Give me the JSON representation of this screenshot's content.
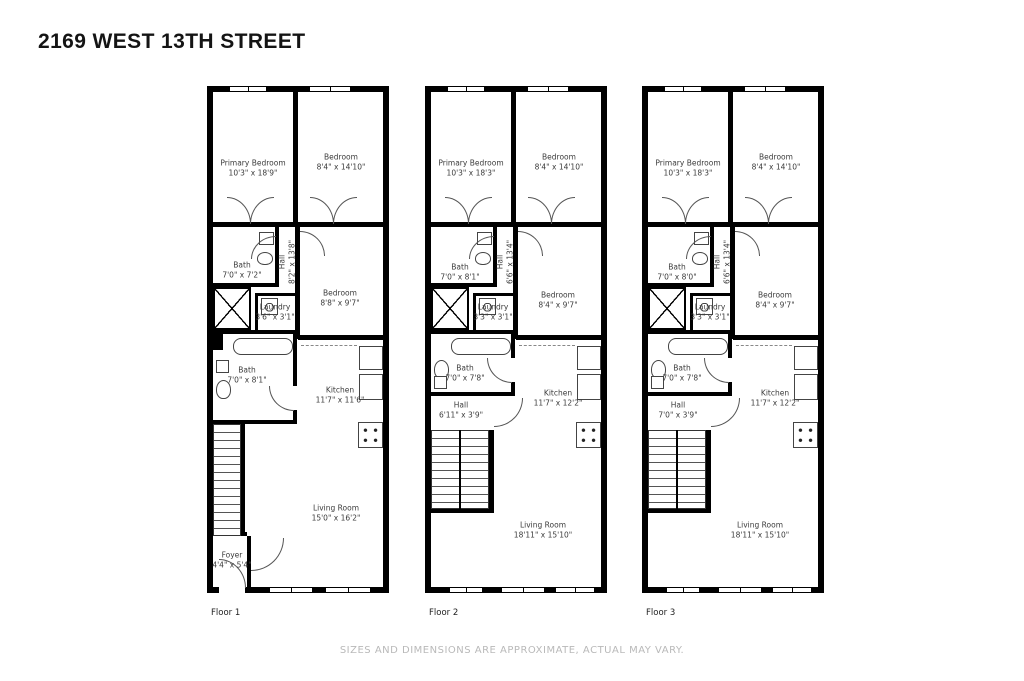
{
  "page": {
    "title": "2169 WEST 13TH STREET",
    "disclaimer": "SIZES AND DIMENSIONS ARE APPROXIMATE, ACTUAL MAY VARY."
  },
  "colors": {
    "wall": "#000000",
    "room_label": "#3b3b3b",
    "disclaimer_text": "#b9b9b9"
  },
  "floors": [
    {
      "label": "Floor 1",
      "rooms": {
        "primary_bedroom": {
          "name": "Primary Bedroom",
          "dims": "10'3\" x 18'9\""
        },
        "bedroom_top": {
          "name": "Bedroom",
          "dims": "8'4\" x 14'10\""
        },
        "bath_upper": {
          "name": "Bath",
          "dims": "7'0\" x 7'2\""
        },
        "hall_upper": {
          "name": "Hall",
          "dims": "8'2\" x 13'8\""
        },
        "laundry": {
          "name": "Laundry",
          "dims": "3'6\" x 3'1\""
        },
        "bedroom_mid": {
          "name": "Bedroom",
          "dims": "8'8\" x 9'7\""
        },
        "bath_lower": {
          "name": "Bath",
          "dims": "7'0\" x 8'1\""
        },
        "kitchen": {
          "name": "Kitchen",
          "dims": "11'7\" x 11'6\""
        },
        "living_room": {
          "name": "Living Room",
          "dims": "15'0\" x 16'2\""
        },
        "foyer": {
          "name": "Foyer",
          "dims": "4'4\" x 5'4\""
        }
      }
    },
    {
      "label": "Floor 2",
      "rooms": {
        "primary_bedroom": {
          "name": "Primary Bedroom",
          "dims": "10'3\" x 18'3\""
        },
        "bedroom_top": {
          "name": "Bedroom",
          "dims": "8'4\" x 14'10\""
        },
        "bath_upper": {
          "name": "Bath",
          "dims": "7'0\" x 8'1\""
        },
        "hall_upper": {
          "name": "Hall",
          "dims": "6'6\" x 13'4\""
        },
        "laundry": {
          "name": "Laundry",
          "dims": "3'3\" x 3'1\""
        },
        "bedroom_mid": {
          "name": "Bedroom",
          "dims": "8'4\" x 9'7\""
        },
        "bath_lower": {
          "name": "Bath",
          "dims": "7'0\" x 7'8\""
        },
        "hall_lower": {
          "name": "Hall",
          "dims": "6'11\" x 3'9\""
        },
        "kitchen": {
          "name": "Kitchen",
          "dims": "11'7\" x 12'2\""
        },
        "living_room": {
          "name": "Living Room",
          "dims": "18'11\" x 15'10\""
        }
      }
    },
    {
      "label": "Floor 3",
      "rooms": {
        "primary_bedroom": {
          "name": "Primary Bedroom",
          "dims": "10'3\" x 18'3\""
        },
        "bedroom_top": {
          "name": "Bedroom",
          "dims": "8'4\" x 14'10\""
        },
        "bath_upper": {
          "name": "Bath",
          "dims": "7'0\" x 8'0\""
        },
        "hall_upper": {
          "name": "Hall",
          "dims": "6'6\" x 13'4\""
        },
        "laundry": {
          "name": "Laundry",
          "dims": "3'3\" x 3'1\""
        },
        "bedroom_mid": {
          "name": "Bedroom",
          "dims": "8'4\" x 9'7\""
        },
        "bath_lower": {
          "name": "Bath",
          "dims": "7'0\" x 7'8\""
        },
        "hall_lower": {
          "name": "Hall",
          "dims": "7'0\" x 3'9\""
        },
        "kitchen": {
          "name": "Kitchen",
          "dims": "11'7\" x 12'2\""
        },
        "living_room": {
          "name": "Living Room",
          "dims": "18'11\" x 15'10\""
        }
      }
    }
  ]
}
